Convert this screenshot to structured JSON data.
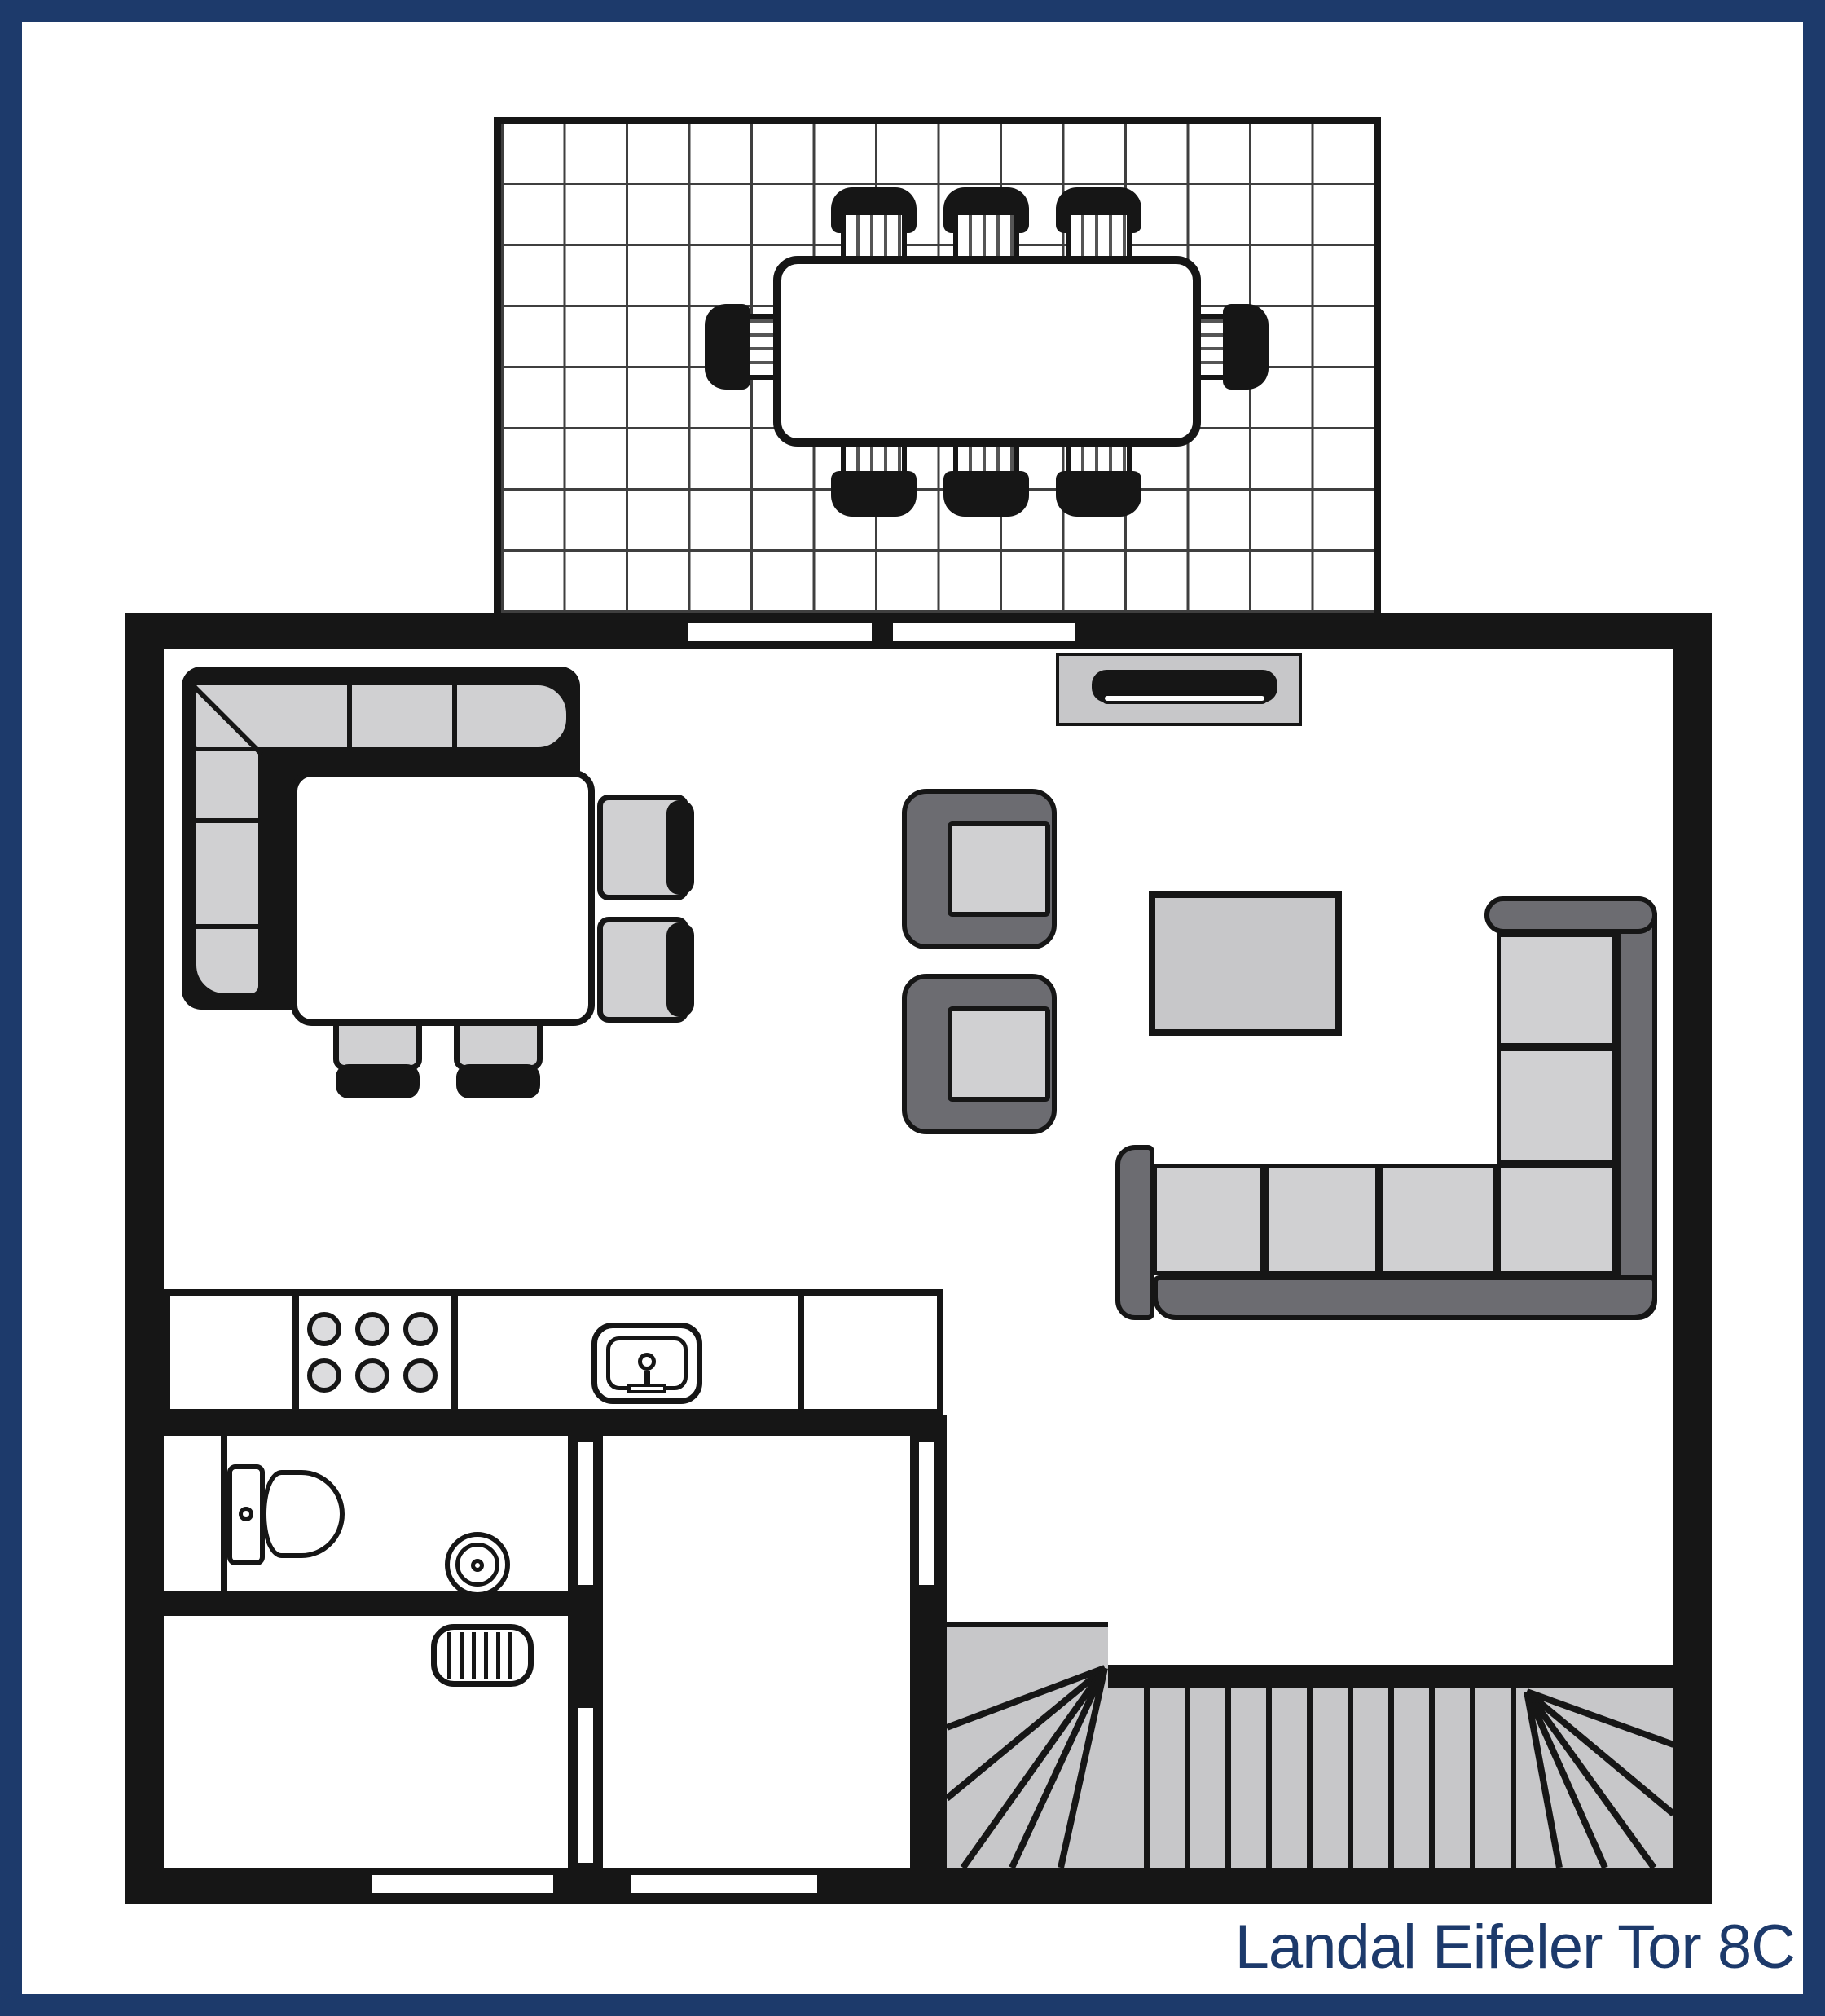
{
  "caption": {
    "text": "Landal Eifeler Tor 8C"
  },
  "colors": {
    "navy": "#1d3a6b",
    "wall": "#161616",
    "light": "#d0d0d2",
    "mid": "#c7c7c9",
    "dark": "#6c6c71",
    "grid": "#3f3f3f",
    "burner": "#dcdcde",
    "white": "#ffffff"
  },
  "plan": {
    "type": "floor-plan",
    "areas": [
      "terrace",
      "living-room",
      "dining-area",
      "kitchen",
      "bathroom",
      "storage-room",
      "hallway",
      "staircase"
    ],
    "counts": {
      "outdoor_chairs": 8,
      "dining_chairs": 4,
      "bench_cushion_segments": 5,
      "armchairs": 2,
      "sofa_seat_cushions": 6,
      "stove_burners": 6,
      "radiator_fins": 6,
      "straight_stair_treads": 10,
      "terrace_grid_columns": 14,
      "terrace_grid_rows": 8,
      "door_openings": 7
    }
  }
}
